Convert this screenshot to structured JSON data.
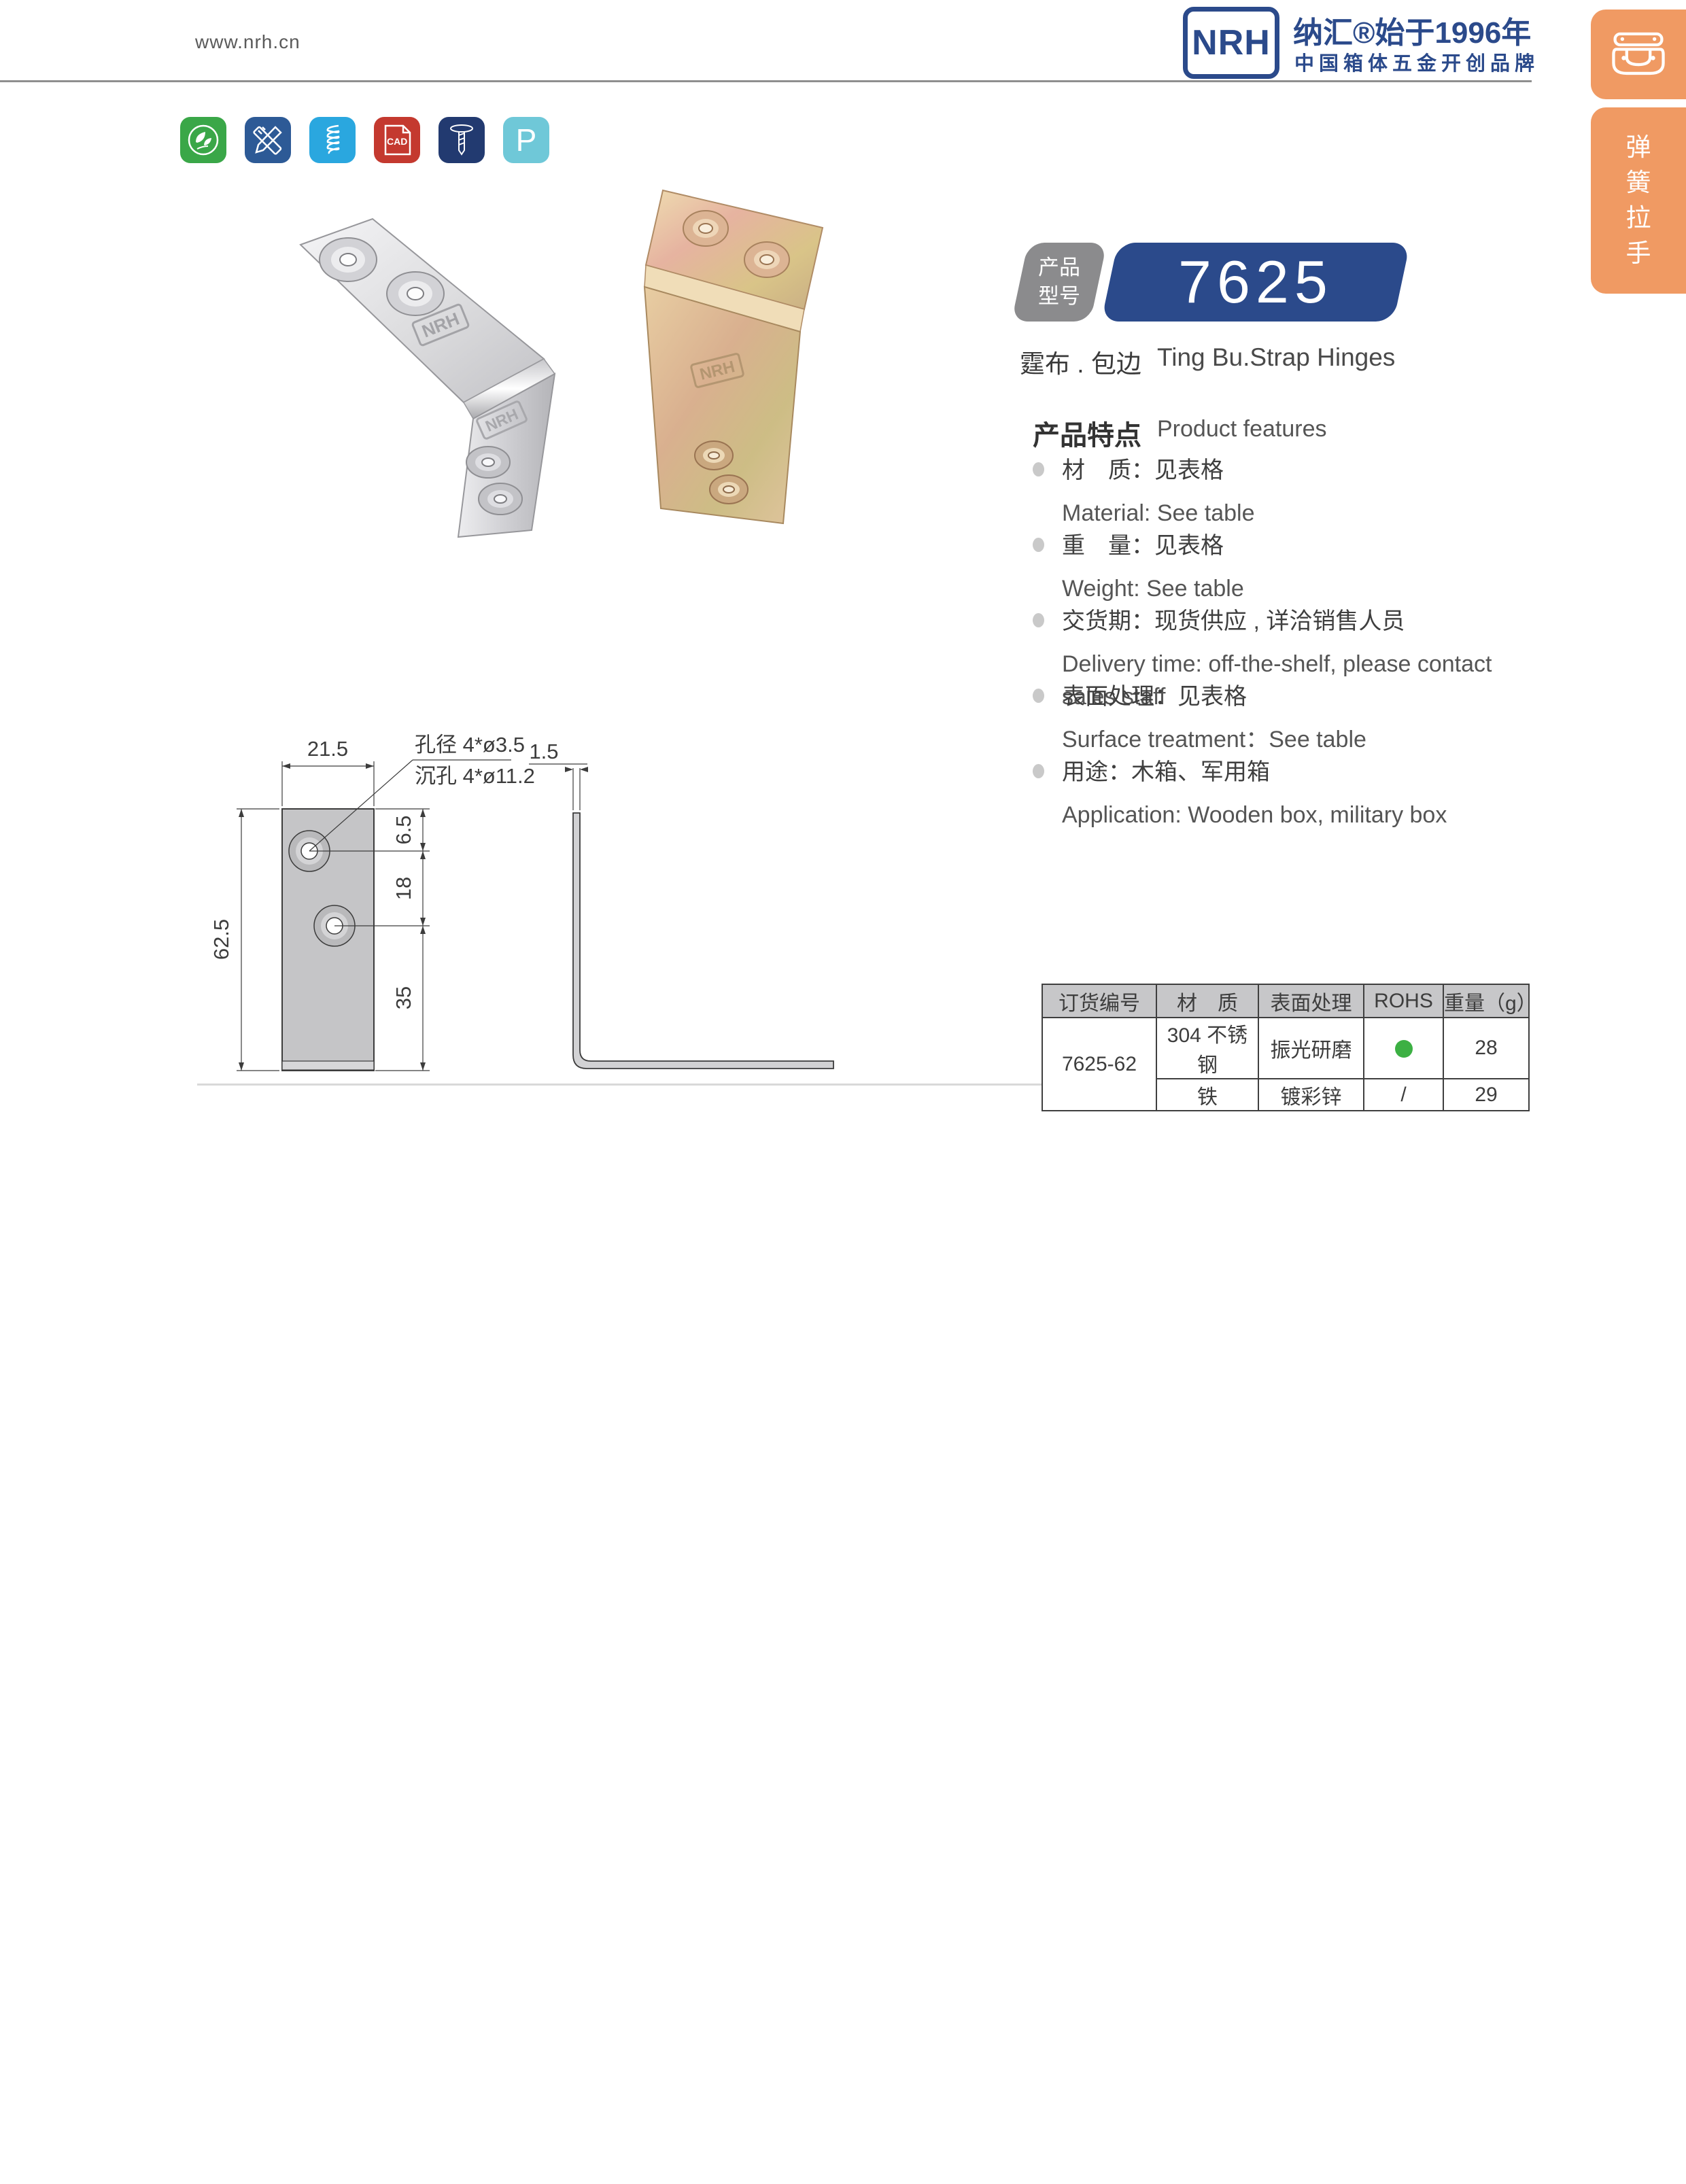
{
  "header": {
    "website": "www.nrh.cn",
    "brand": {
      "logo_text": "NRH",
      "tagline_line1": "纳汇®始于1996年",
      "tagline_line2": "中国箱体五金开创品牌",
      "brand_color": "#2b4a8b"
    }
  },
  "toolbar_icons": [
    {
      "name": "eco-leaf-icon",
      "color": "#3aa748"
    },
    {
      "name": "design-tools-icon",
      "color": "#2d5a96"
    },
    {
      "name": "spring-icon",
      "color": "#2aa7df"
    },
    {
      "name": "cad-file-icon",
      "color": "#c4392f",
      "label": "CAD"
    },
    {
      "name": "screw-icon",
      "color": "#223a70"
    },
    {
      "name": "p-icon",
      "color": "#6fc8d8",
      "label": "P"
    }
  ],
  "product": {
    "badge_label_line1": "产品",
    "badge_label_line2": "型号",
    "model": "7625",
    "subtitle_cn": "霆布 . 包边",
    "subtitle_en": "Ting Bu.Strap Hinges",
    "stamp": "NRH"
  },
  "features": {
    "heading_cn": "产品特点",
    "heading_en": "Product features",
    "items": [
      {
        "cn": "材　质：见表格",
        "en": "Material: See table"
      },
      {
        "cn": "重　量：见表格",
        "en": "Weight: See table"
      },
      {
        "cn": "交货期：现货供应 , 详洽销售人员",
        "en": "Delivery time: off-the-shelf, please contact sales staff"
      },
      {
        "cn": "表面处理：见表格",
        "en": "Surface treatment：See table"
      },
      {
        "cn": "用途：木箱、军用箱",
        "en": "Application: Wooden box, military box"
      }
    ]
  },
  "drawing": {
    "hole_note_line1": "孔径 4*ø3.5",
    "hole_note_line2": "沉孔 4*ø11.2",
    "dims": {
      "width": "21.5",
      "height": "62.5",
      "hole_offset_top": "6.5",
      "hole_spacing": "18",
      "hole_to_bottom": "35",
      "thickness": "1.5"
    }
  },
  "table": {
    "headers": [
      "订货编号",
      "材　质",
      "表面处理",
      "ROHS",
      "重量（g）"
    ],
    "order_no": "7625-62",
    "rows": [
      {
        "material": "304 不锈钢",
        "surface": "振光研磨",
        "rohs": "pass",
        "weight": "28"
      },
      {
        "material": "铁",
        "surface": "镀彩锌",
        "rohs": "/",
        "weight": "29"
      }
    ],
    "rohs_pass_color": "#3cb043"
  },
  "sidebar": {
    "color": "#f09a63",
    "latch_icon": "draw-latch-icon",
    "vertical_label": "弹簧拉手",
    "chars": [
      "弹",
      "簧",
      "拉",
      "手"
    ]
  }
}
